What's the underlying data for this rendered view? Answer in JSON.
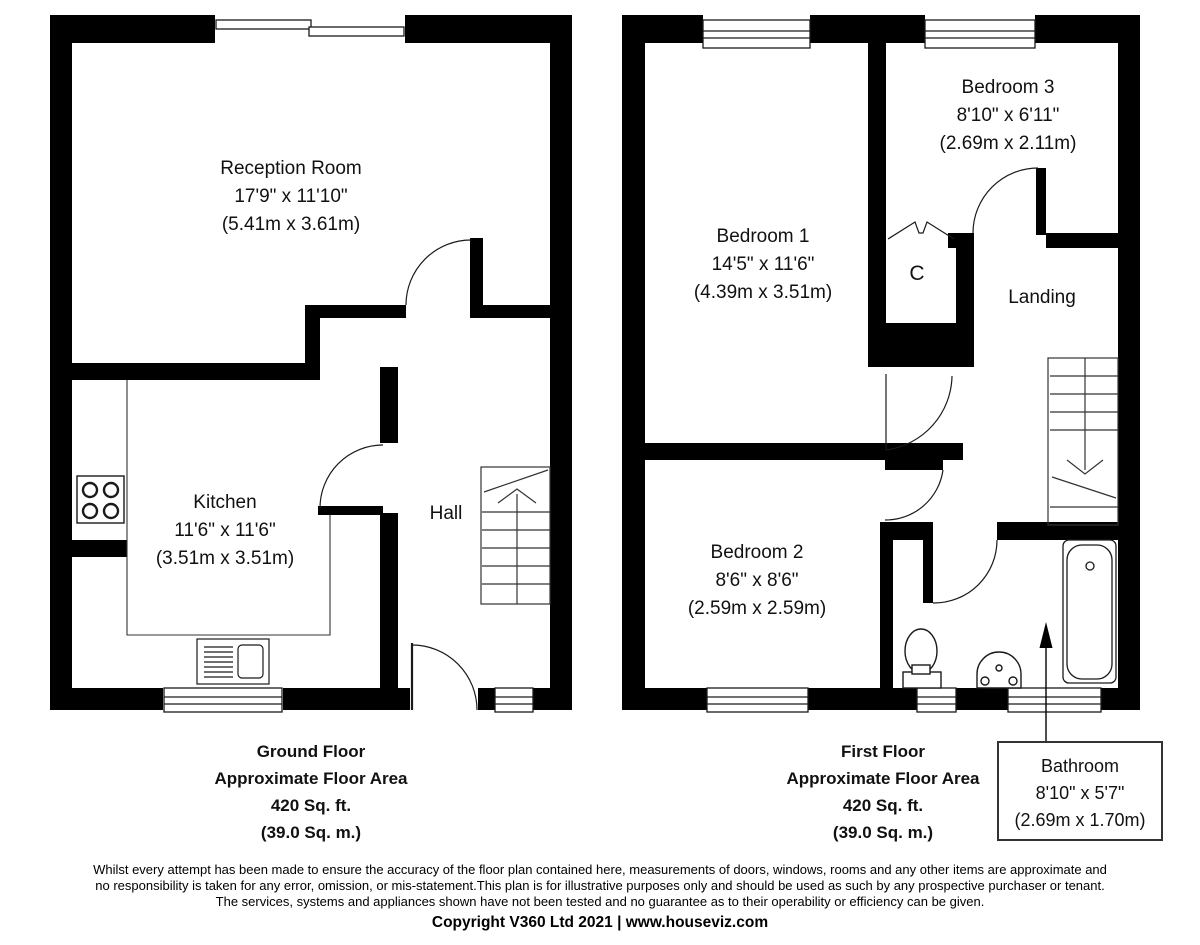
{
  "plan": {
    "ground_floor": {
      "rooms": {
        "reception": {
          "name": "Reception Room",
          "imperial": "17'9\" x 11'10\"",
          "metric": "(5.41m x 3.61m)"
        },
        "kitchen": {
          "name": "Kitchen",
          "imperial": "11'6\" x 11'6\"",
          "metric": "(3.51m x 3.51m)"
        },
        "hall": {
          "name": "Hall"
        }
      },
      "area": {
        "title": "Ground Floor",
        "line2": "Approximate Floor Area",
        "line3": "420 Sq. ft.",
        "line4": "(39.0 Sq. m.)"
      }
    },
    "first_floor": {
      "rooms": {
        "bedroom1": {
          "name": "Bedroom 1",
          "imperial": "14'5\" x 11'6\"",
          "metric": "(4.39m x 3.51m)"
        },
        "bedroom2": {
          "name": "Bedroom 2",
          "imperial": "8'6\" x 8'6\"",
          "metric": "(2.59m x 2.59m)"
        },
        "bedroom3": {
          "name": "Bedroom 3",
          "imperial": "8'10\" x 6'11\"",
          "metric": "(2.69m x 2.11m)"
        },
        "cupboard": {
          "name": "C"
        },
        "landing": {
          "name": "Landing"
        },
        "bathroom": {
          "name": "Bathroom",
          "imperial": "8'10\" x 5'7\"",
          "metric": "(2.69m x 1.70m)"
        }
      },
      "area": {
        "title": "First Floor",
        "line2": "Approximate Floor Area",
        "line3": "420 Sq. ft.",
        "line4": "(39.0 Sq. m.)"
      }
    },
    "colors": {
      "wall": "#000000",
      "line": "#1a1a1a",
      "background": "#ffffff"
    }
  },
  "footer": {
    "disclaimer_line1": "Whilst every attempt has been made to ensure the accuracy of the floor plan contained here, measurements of doors, windows, rooms and any other items are approximate and",
    "disclaimer_line2": "no responsibility is taken for any error, omission, or mis-statement.This plan is for illustrative purposes only and should be used as such by any prospective purchaser or tenant.",
    "disclaimer_line3": "The services, systems and appliances shown have not been tested and no guarantee as to their operability or efficiency can be given.",
    "copyright": "Copyright V360 Ltd 2021 | www.houseviz.com"
  }
}
